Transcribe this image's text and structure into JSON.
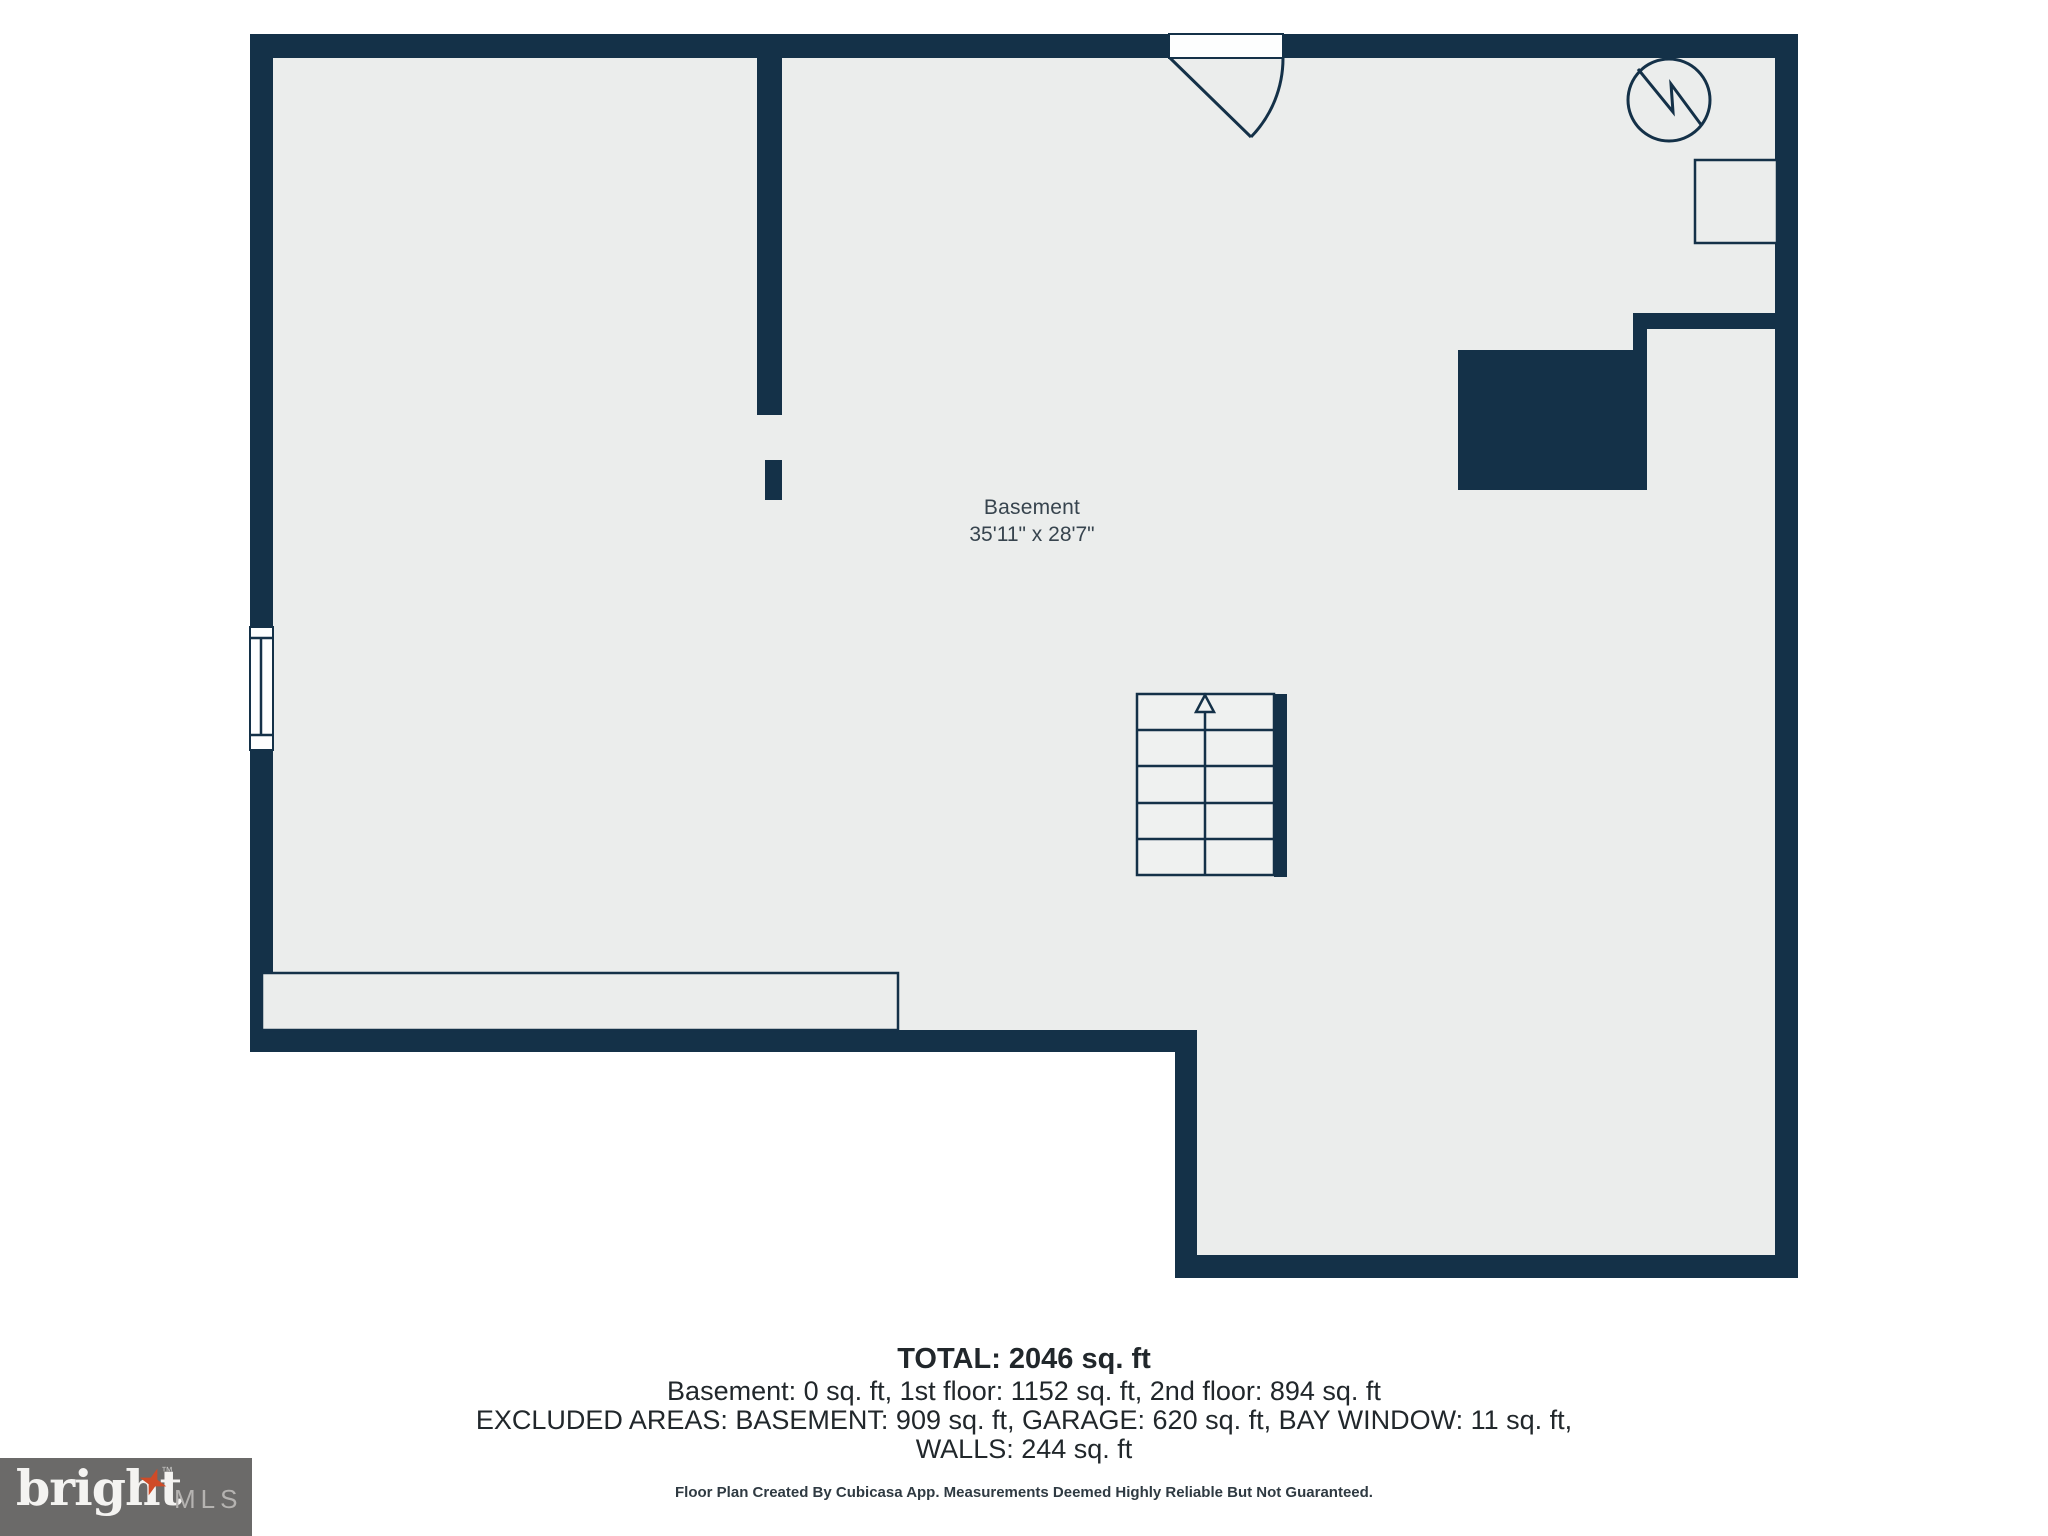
{
  "colors": {
    "wall": "#143148",
    "floor": "#ebedec",
    "page_bg": "#ffffff",
    "label_text": "#37444e",
    "body_text": "#21272b",
    "logo_bg": "#6b6a69",
    "logo_brand": "#f4f3f1",
    "logo_suffix": "#b5b3b1",
    "logo_star": "#cf4b27"
  },
  "plan": {
    "room": {
      "name": "Basement",
      "dimensions": "35'11\" x 28'7\""
    },
    "icons": {
      "water_heater": "circle-with-zigzag",
      "stairs_direction": "up-arrow",
      "door": "quarter-swing-arc",
      "window": "double-line-window"
    }
  },
  "summary": {
    "total": "TOTAL: 2046 sq. ft",
    "floors": "Basement: 0 sq. ft, 1st floor: 1152 sq. ft, 2nd floor: 894 sq. ft",
    "excluded": "EXCLUDED AREAS: BASEMENT: 909 sq. ft, GARAGE: 620 sq. ft, BAY WINDOW: 11 sq. ft,",
    "walls": "WALLS: 244 sq. ft",
    "disclaimer": "Floor Plan Created By Cubicasa App. Measurements Deemed Highly Reliable But Not Guaranteed."
  },
  "logo": {
    "brand": "bright",
    "trademark": "™",
    "suffix": "MLS"
  }
}
